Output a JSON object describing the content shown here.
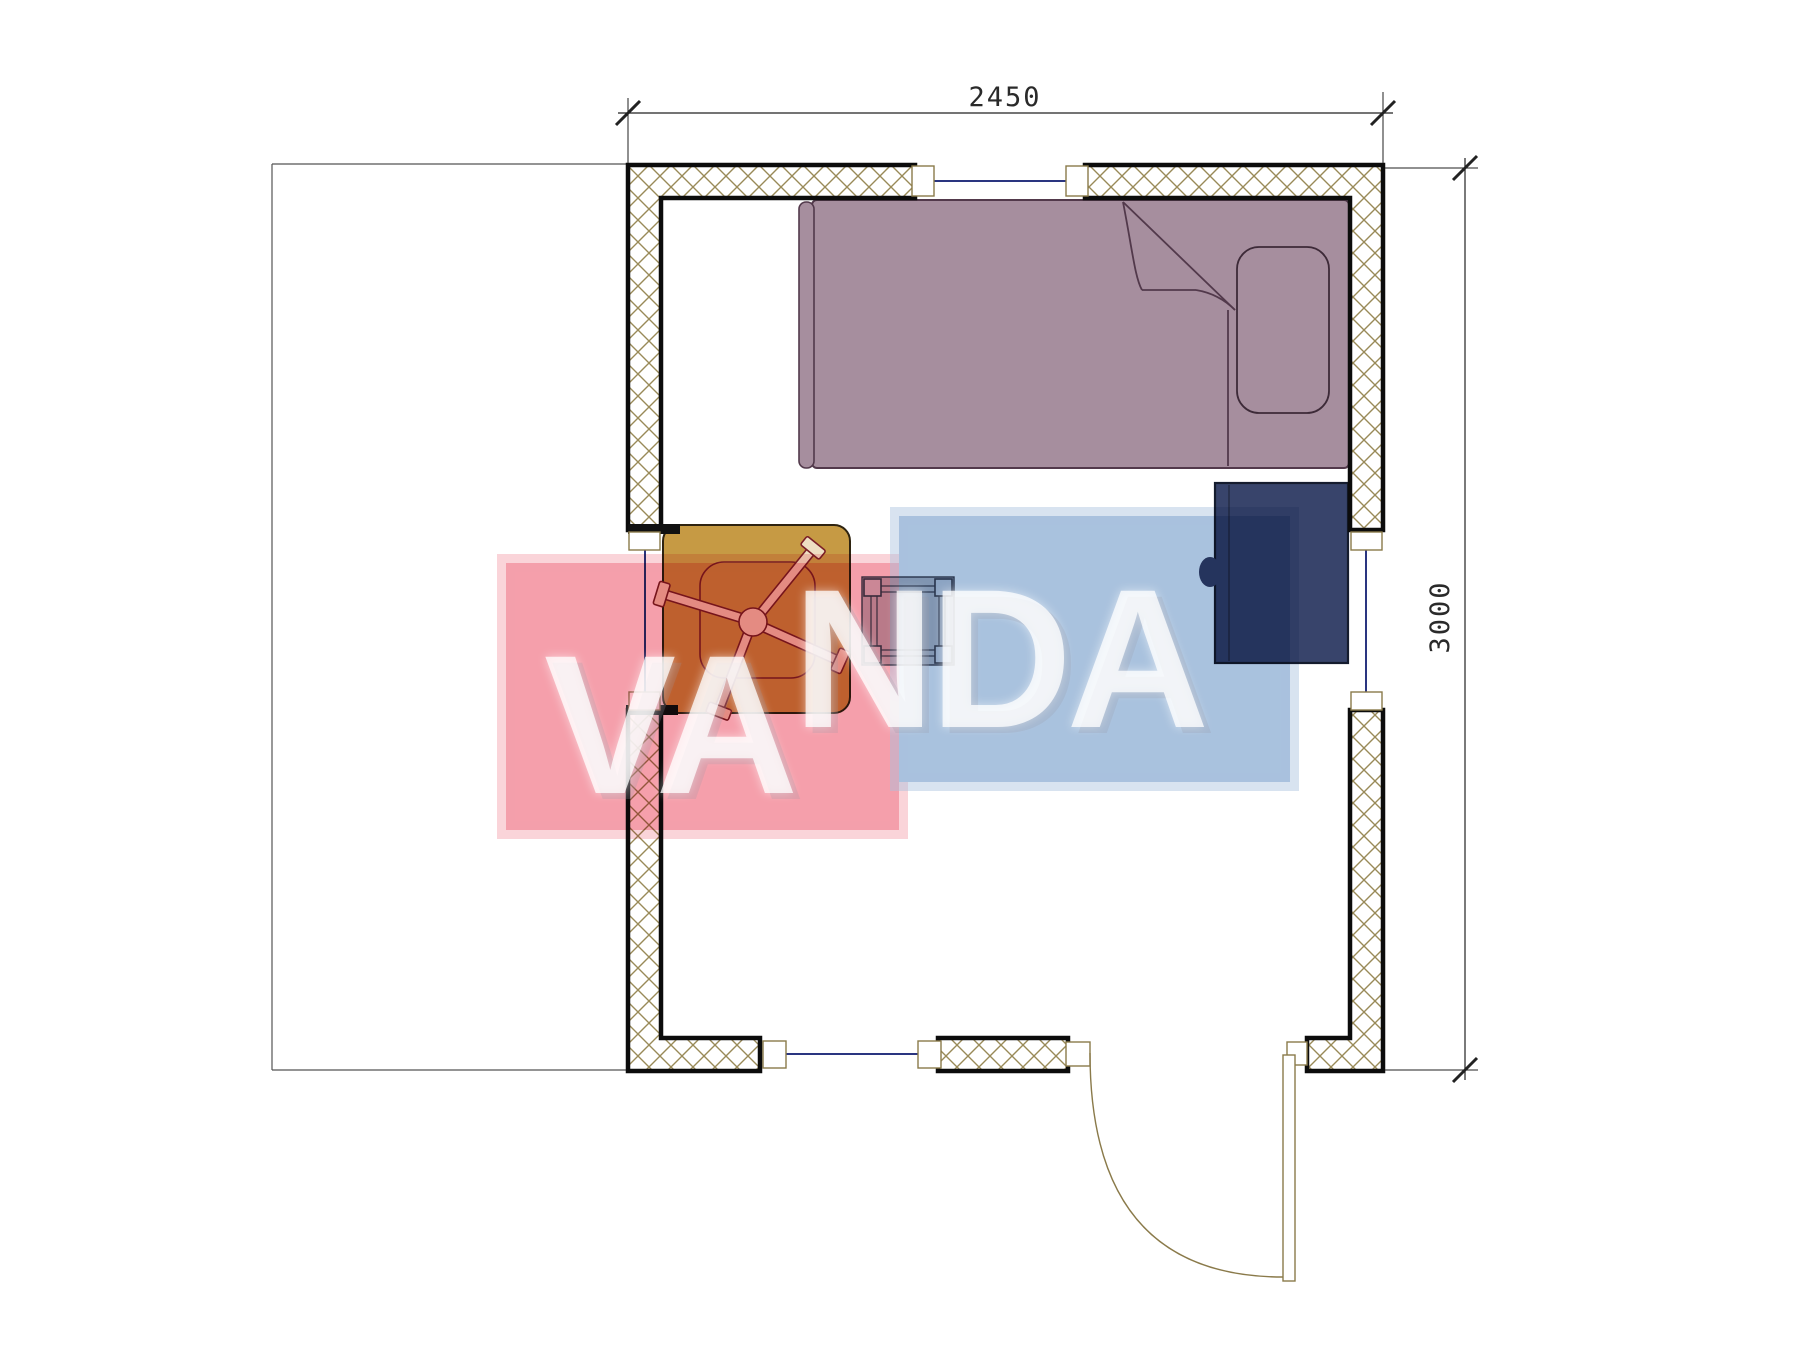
{
  "plan": {
    "dimension_width_label": "2450",
    "dimension_height_label": "3000"
  },
  "watermark": {
    "part1": "VA",
    "part2": "NDA",
    "pink_color": "#f59fab",
    "blue_color": "#a9c2de"
  },
  "colors": {
    "bed_fill": "#a68e9e",
    "bed_outline": "#52394b",
    "pillow_fill": "#a68e9e",
    "wardrobe_fill": "#38446b",
    "wardrobe_outline": "#151c2e",
    "table_fill": "#c69a44",
    "table_outline": "#2e2310",
    "fan_line": "#7b1f28",
    "fan_fill": "#eedfc2",
    "stool_line": "#3a4356",
    "wall_hatch": "#998a58",
    "window_glass": "#2a3580",
    "door_line": "#8a7a4a",
    "dimension_line": "#222222",
    "site_line": "#555555"
  }
}
